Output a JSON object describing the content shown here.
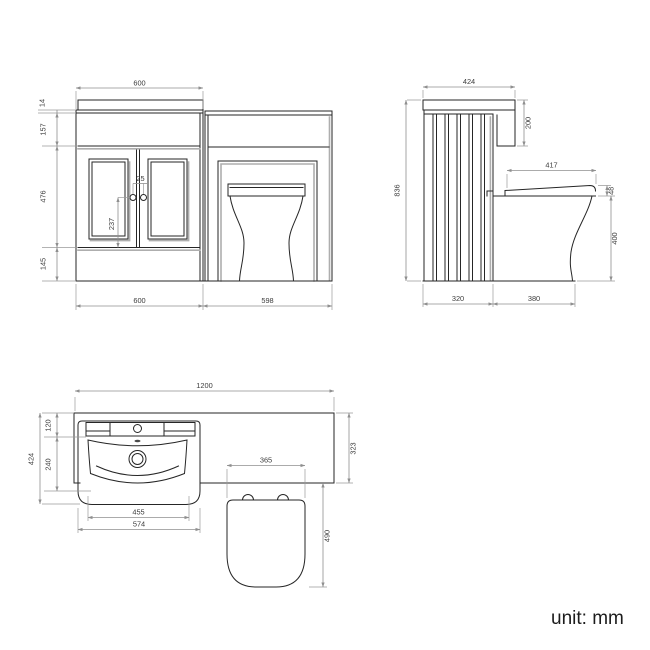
{
  "unit_label": "unit: mm",
  "views": {
    "front": {
      "label": "front-elevation",
      "dims": {
        "worktop_width": "600",
        "worktop_lip": "14",
        "fascia_height": "157",
        "door_height": "476",
        "plinth_height": "145",
        "handle_gap": "25",
        "handle_drop": "237",
        "vanity_width": "600",
        "wc_width": "598"
      }
    },
    "side": {
      "label": "side-elevation",
      "dims": {
        "top_depth": "424",
        "end_drop": "200",
        "height": "836",
        "seat_len": "417",
        "seat_thk": "48",
        "pan_h": "400",
        "cab_depth": "320",
        "pan_proj": "380"
      }
    },
    "plan": {
      "label": "plan-view",
      "dims": {
        "width": "1200",
        "ledge_depth": "120",
        "bowl_depth": "240",
        "depth": "424",
        "counter_depth": "323",
        "bowl_width": "455",
        "basin_width": "574",
        "seat_width": "365",
        "pan_proj": "490"
      }
    }
  },
  "colors": {
    "line": "#262626",
    "shadow": "#aeaeae",
    "dimension": "#8f8f8f",
    "dim_text": "#3c3c3c",
    "background": "#ffffff"
  }
}
